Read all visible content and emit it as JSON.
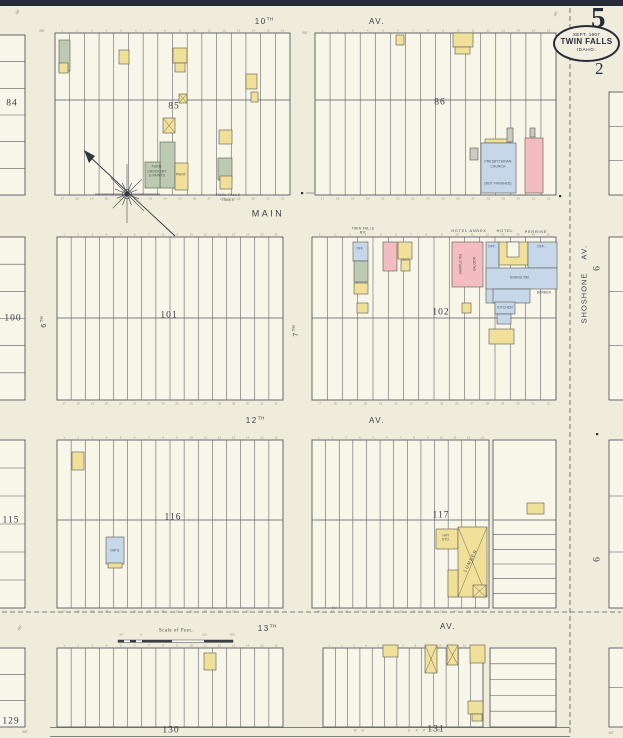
{
  "sheet": {
    "number": "5",
    "sub_number": "2",
    "stamp_date": "SEPT. 1907",
    "stamp_city": "TWIN FALLS",
    "stamp_state": "IDAHO."
  },
  "colors": {
    "paper": "#f0ecdc",
    "block_fill": "#f8f5e9",
    "ink": "#565a61",
    "navy": "#262b38",
    "yellow": "#f1e099",
    "pink": "#f3bcc1",
    "blue": "#c7d7ea",
    "green": "#bccab2",
    "gray": "#cbcbc3",
    "white": "#f8f5e9"
  },
  "map": {
    "blocks": [
      {
        "id": "85",
        "x": 55,
        "y": 33,
        "w": 235,
        "h": 162,
        "split": 100,
        "lots": 16,
        "nums": "both"
      },
      {
        "id": "86",
        "x": 315,
        "y": 33,
        "w": 241,
        "h": 162,
        "split": 100,
        "lots": 16,
        "nums": "both"
      },
      {
        "id": "101",
        "x": 57,
        "y": 237,
        "w": 226,
        "h": 163,
        "split": 318,
        "lots": 16,
        "nums": "both"
      },
      {
        "id": "102",
        "x": 312,
        "y": 237,
        "w": 244,
        "h": 163,
        "split": 318,
        "lots": 16,
        "nums": "both"
      },
      {
        "id": "116",
        "x": 57,
        "y": 440,
        "w": 226,
        "h": 168,
        "split": 520,
        "lots": 16,
        "nums": "both"
      },
      {
        "id": "117",
        "x": 312,
        "y": 440,
        "w": 177,
        "h": 168,
        "split": 520,
        "lots": 13,
        "nums": "both"
      },
      {
        "id": "117-side",
        "x": 493,
        "y": 440,
        "w": 63,
        "h": 168,
        "split": 520,
        "hb": 6
      },
      {
        "id": "130",
        "x": 57,
        "y": 648,
        "w": 226,
        "h": 79,
        "lots": 16,
        "nums": "top"
      },
      {
        "id": "131",
        "x": 323,
        "y": 648,
        "w": 160,
        "h": 79,
        "lots": 13,
        "nums": "top"
      },
      {
        "id": "131-side",
        "x": 490,
        "y": 648,
        "w": 66,
        "h": 79,
        "hrows": 5
      },
      {
        "id": "84",
        "x": -3,
        "y": 35,
        "w": 28,
        "h": 160,
        "hrows": 6
      },
      {
        "id": "100",
        "x": -3,
        "y": 237,
        "w": 28,
        "h": 163,
        "hrows": 6
      },
      {
        "id": "115",
        "x": -3,
        "y": 440,
        "w": 28,
        "h": 168,
        "hrows": 6
      },
      {
        "id": "129",
        "x": -3,
        "y": 648,
        "w": 28,
        "h": 79,
        "hrows": 3
      },
      {
        "id": "right-1",
        "x": 609,
        "y": 92,
        "w": 15,
        "h": 103,
        "hrows": 3
      },
      {
        "id": "right-2",
        "x": 609,
        "y": 237,
        "w": 15,
        "h": 163,
        "hrows": 3
      },
      {
        "id": "right-3",
        "x": 609,
        "y": 440,
        "w": 15,
        "h": 168,
        "hrows": 3
      },
      {
        "id": "right-4",
        "x": 609,
        "y": 648,
        "w": 15,
        "h": 79,
        "hrows": 2
      }
    ],
    "lines": [
      [
        50,
        727.5,
        570,
        727.5,
        0.7,
        ""
      ],
      [
        50,
        736.5,
        570,
        736.5,
        0.7,
        ""
      ],
      [
        570,
        8,
        570,
        736,
        0.8,
        "5 3"
      ],
      [
        2,
        612,
        621,
        612,
        0.8,
        "5 3"
      ],
      [
        306,
        193,
        314,
        193,
        0.6,
        ""
      ]
    ],
    "buildings": [
      {
        "x": 59,
        "y": 40,
        "w": 11,
        "h": 31,
        "c": "green"
      },
      {
        "x": 59,
        "y": 63,
        "w": 9,
        "h": 10,
        "c": "yellow"
      },
      {
        "x": 119,
        "y": 50,
        "w": 10,
        "h": 14,
        "c": "yellow"
      },
      {
        "x": 173,
        "y": 48,
        "w": 14,
        "h": 15,
        "c": "yellow"
      },
      {
        "x": 175,
        "y": 63,
        "w": 10,
        "h": 9,
        "c": "yellow"
      },
      {
        "x": 179,
        "y": 94,
        "w": 8,
        "h": 9,
        "c": "yellow",
        "m": true
      },
      {
        "x": 246,
        "y": 74,
        "w": 11,
        "h": 15,
        "c": "yellow"
      },
      {
        "x": 251,
        "y": 92,
        "w": 7,
        "h": 10,
        "c": "yellow"
      },
      {
        "x": 163,
        "y": 118,
        "w": 12,
        "h": 15,
        "c": "yellow",
        "m": true
      },
      {
        "x": 160,
        "y": 142,
        "w": 15,
        "h": 46,
        "c": "green"
      },
      {
        "x": 145,
        "y": 162,
        "w": 15,
        "h": 26,
        "c": "green"
      },
      {
        "x": 175,
        "y": 163,
        "w": 13,
        "h": 27,
        "c": "yellow"
      },
      {
        "x": 219,
        "y": 130,
        "w": 13,
        "h": 14,
        "c": "yellow"
      },
      {
        "x": 218,
        "y": 158,
        "w": 14,
        "h": 22,
        "c": "green"
      },
      {
        "x": 220,
        "y": 176,
        "w": 12,
        "h": 13,
        "c": "yellow"
      },
      {
        "x": 396,
        "y": 35,
        "w": 8,
        "h": 10,
        "c": "yellow"
      },
      {
        "x": 453,
        "y": 33,
        "w": 20,
        "h": 14,
        "c": "yellow"
      },
      {
        "x": 455,
        "y": 47,
        "w": 15,
        "h": 7,
        "c": "yellow"
      },
      {
        "x": 485,
        "y": 139,
        "w": 25,
        "h": 4,
        "c": "yellow"
      },
      {
        "x": 481,
        "y": 143,
        "w": 35,
        "h": 50,
        "c": "blue"
      },
      {
        "x": 470,
        "y": 148,
        "w": 8,
        "h": 12,
        "c": "gray"
      },
      {
        "x": 507,
        "y": 128,
        "w": 6,
        "h": 14,
        "c": "gray"
      },
      {
        "x": 525,
        "y": 138,
        "w": 18,
        "h": 55,
        "c": "pink"
      },
      {
        "x": 530,
        "y": 128,
        "w": 5,
        "h": 9,
        "c": "gray"
      },
      {
        "x": 353,
        "y": 242,
        "w": 15,
        "h": 19,
        "c": "blue"
      },
      {
        "x": 354,
        "y": 261,
        "w": 14,
        "h": 21,
        "c": "green"
      },
      {
        "x": 354,
        "y": 283,
        "w": 14,
        "h": 11,
        "c": "yellow"
      },
      {
        "x": 357,
        "y": 303,
        "w": 11,
        "h": 10,
        "c": "yellow"
      },
      {
        "x": 383,
        "y": 242,
        "w": 14,
        "h": 29,
        "c": "pink"
      },
      {
        "x": 398,
        "y": 242,
        "w": 14,
        "h": 17,
        "c": "yellow"
      },
      {
        "x": 401,
        "y": 260,
        "w": 9,
        "h": 11,
        "c": "yellow"
      },
      {
        "x": 452,
        "y": 242,
        "w": 31,
        "h": 45,
        "c": "pink"
      },
      {
        "x": 486,
        "y": 242,
        "w": 13,
        "h": 61,
        "c": "blue"
      },
      {
        "x": 499,
        "y": 242,
        "w": 29,
        "h": 23,
        "c": "yellow"
      },
      {
        "x": 507,
        "y": 242,
        "w": 12,
        "h": 15,
        "c": "white"
      },
      {
        "x": 528,
        "y": 242,
        "w": 29,
        "h": 26,
        "c": "blue"
      },
      {
        "x": 486,
        "y": 268,
        "w": 71,
        "h": 21,
        "c": "blue"
      },
      {
        "x": 493,
        "y": 289,
        "w": 37,
        "h": 14,
        "c": "blue"
      },
      {
        "x": 495,
        "y": 302,
        "w": 20,
        "h": 12,
        "c": "blue"
      },
      {
        "x": 497,
        "y": 314,
        "w": 14,
        "h": 10,
        "c": "blue"
      },
      {
        "x": 462,
        "y": 303,
        "w": 9,
        "h": 10,
        "c": "yellow"
      },
      {
        "x": 489,
        "y": 329,
        "w": 25,
        "h": 15,
        "c": "yellow"
      },
      {
        "x": 72,
        "y": 452,
        "w": 12,
        "h": 18,
        "c": "yellow"
      },
      {
        "x": 106,
        "y": 537,
        "w": 18,
        "h": 27,
        "c": "blue"
      },
      {
        "x": 108,
        "y": 563,
        "w": 14,
        "h": 5,
        "c": "yellow"
      },
      {
        "x": 527,
        "y": 503,
        "w": 17,
        "h": 11,
        "c": "yellow"
      },
      {
        "x": 436,
        "y": 529,
        "w": 22,
        "h": 20,
        "c": "yellow"
      },
      {
        "x": 458,
        "y": 527,
        "w": 29,
        "h": 70,
        "c": "yellow",
        "m": true
      },
      {
        "x": 448,
        "y": 570,
        "w": 10,
        "h": 27,
        "c": "yellow"
      },
      {
        "x": 473,
        "y": 585,
        "w": 13,
        "h": 12,
        "c": "yellow",
        "m": true
      },
      {
        "x": 204,
        "y": 653,
        "w": 12,
        "h": 17,
        "c": "yellow"
      },
      {
        "x": 383,
        "y": 645,
        "w": 15,
        "h": 12,
        "c": "yellow"
      },
      {
        "x": 425,
        "y": 645,
        "w": 12,
        "h": 28,
        "c": "yellow",
        "m": true
      },
      {
        "x": 447,
        "y": 645,
        "w": 11,
        "h": 20,
        "c": "yellow",
        "m": true
      },
      {
        "x": 470,
        "y": 645,
        "w": 15,
        "h": 18,
        "c": "yellow"
      },
      {
        "x": 468,
        "y": 701,
        "w": 15,
        "h": 13,
        "c": "yellow"
      },
      {
        "x": 472,
        "y": 714,
        "w": 10,
        "h": 7,
        "c": "yellow"
      }
    ],
    "dots": [
      [
        301,
        192
      ],
      [
        559,
        195
      ],
      [
        596,
        433
      ]
    ],
    "compass": {
      "cx": 127,
      "cy": 194,
      "x1": 88,
      "y1": 155,
      "x2": 175,
      "y2": 236
    },
    "scale": {
      "x": 118,
      "w": 115
    },
    "labels": [
      {
        "k": "st",
        "t": "10",
        "sup": "TH",
        "x": 264,
        "y": 22
      },
      {
        "k": "st",
        "t": "AV.",
        "x": 377,
        "y": 22
      },
      {
        "k": "st",
        "t": "MAIN",
        "x": 268,
        "y": 214,
        "s": 9,
        "ls": 2.5
      },
      {
        "k": "st",
        "t": "12",
        "sup": "TH",
        "x": 255,
        "y": 421
      },
      {
        "k": "st",
        "t": "AV.",
        "x": 377,
        "y": 421
      },
      {
        "k": "st",
        "t": "13",
        "sup": "TH",
        "x": 267,
        "y": 629
      },
      {
        "k": "st",
        "t": "AV.",
        "x": 448,
        "y": 627
      },
      {
        "k": "st",
        "t": "SHOSHONE",
        "x": 584,
        "y": 298,
        "r": -90,
        "s": 7.5,
        "ls": 1
      },
      {
        "k": "st",
        "t": "AV.",
        "x": 584,
        "y": 252,
        "r": -90,
        "s": 7.5
      },
      {
        "k": "st",
        "t": "6",
        "sup": "TH",
        "x": 44,
        "y": 322,
        "r": -90,
        "s": 7
      },
      {
        "k": "st",
        "t": "7",
        "sup": "TH",
        "x": 296,
        "y": 331,
        "r": -90,
        "s": 7
      },
      {
        "k": "bn",
        "t": "85",
        "x": 174,
        "y": 107
      },
      {
        "k": "bn",
        "t": "86",
        "x": 440,
        "y": 103
      },
      {
        "k": "bn",
        "t": "101",
        "x": 169,
        "y": 316
      },
      {
        "k": "bn",
        "t": "102",
        "x": 441,
        "y": 313
      },
      {
        "k": "bn",
        "t": "116",
        "x": 173,
        "y": 518
      },
      {
        "k": "bn",
        "t": "117",
        "x": 441,
        "y": 516
      },
      {
        "k": "bn",
        "t": "130",
        "x": 171,
        "y": 731
      },
      {
        "k": "bn",
        "t": "131",
        "x": 436,
        "y": 730
      },
      {
        "k": "bn",
        "t": "84",
        "x": 12,
        "y": 104
      },
      {
        "k": "bn",
        "t": "100",
        "x": 13,
        "y": 319
      },
      {
        "k": "bn",
        "t": "115",
        "x": 11,
        "y": 521
      },
      {
        "k": "bn",
        "t": "129",
        "x": 11,
        "y": 722
      },
      {
        "k": "bn",
        "t": "6",
        "x": 598,
        "y": 268,
        "r": -90
      },
      {
        "k": "bn",
        "t": "6",
        "x": 598,
        "y": 559,
        "r": -90
      },
      {
        "k": "cap",
        "t": "TWIN FALLS",
        "x": 228,
        "y": 196,
        "s": 3.6
      },
      {
        "k": "cap",
        "t": "“TIMES”",
        "x": 228,
        "y": 201,
        "s": 3.6
      },
      {
        "k": "cap",
        "t": "TWIN FALLS",
        "x": 363,
        "y": 229,
        "s": 3.2
      },
      {
        "k": "cap",
        "t": "B'K",
        "x": 363,
        "y": 233,
        "s": 3.2
      },
      {
        "k": "cap",
        "t": "HOTEL ANNEX",
        "x": 469,
        "y": 232,
        "s": 3.8,
        "ls": 0.8
      },
      {
        "k": "cap",
        "t": "HOTEL",
        "x": 505,
        "y": 232,
        "s": 3.8,
        "ls": 0.8
      },
      {
        "k": "cap",
        "t": "PERRINE",
        "x": 536,
        "y": 233,
        "s": 3.8,
        "ls": 0.8
      },
      {
        "k": "scale",
        "t": "Scale of Feet.",
        "x": 176,
        "y": 631
      },
      {
        "k": "bld",
        "t": "FURN.",
        "x": 157,
        "y": 167
      },
      {
        "k": "bld",
        "t": "CROCKERY",
        "x": 157,
        "y": 171.5
      },
      {
        "k": "bld",
        "t": "& PAINTS",
        "x": 157,
        "y": 176
      },
      {
        "k": "bld",
        "t": "PAINT",
        "x": 181,
        "y": 175
      },
      {
        "k": "bld",
        "t": "PRESBYTERIAN",
        "x": 498,
        "y": 162
      },
      {
        "k": "bld",
        "t": "CHURCH",
        "x": 498,
        "y": 166.5
      },
      {
        "k": "bld",
        "t": "(NOT FINISHED)",
        "x": 498,
        "y": 184
      },
      {
        "k": "bld",
        "t": "SAMPLE RM",
        "x": 461,
        "y": 264,
        "r": -90
      },
      {
        "k": "bld",
        "t": "SALOON",
        "x": 475,
        "y": 264,
        "r": -90
      },
      {
        "k": "bld",
        "t": "OFF.",
        "x": 360,
        "y": 249
      },
      {
        "k": "bld",
        "t": "OFF.",
        "x": 492,
        "y": 247
      },
      {
        "k": "bld",
        "t": "OFF.",
        "x": 541,
        "y": 247
      },
      {
        "k": "bld",
        "t": "DINING RM.",
        "x": 520,
        "y": 278
      },
      {
        "k": "bld",
        "t": "KITCHEN",
        "x": 505,
        "y": 308
      },
      {
        "k": "bld",
        "t": "BARBER",
        "x": 544,
        "y": 293
      },
      {
        "k": "bld",
        "t": "HAY",
        "x": 446,
        "y": 536
      },
      {
        "k": "bld",
        "t": "STO.",
        "x": 446,
        "y": 540
      },
      {
        "k": "bld",
        "t": "LUMBER",
        "x": 471,
        "y": 561,
        "s": 4.5,
        "r": -62,
        "ls": 1
      },
      {
        "k": "bld",
        "t": "DW'G",
        "x": 115,
        "y": 551
      },
      {
        "k": "dim",
        "t": "50'",
        "x": 18,
        "y": 12,
        "r": -65
      },
      {
        "k": "dim",
        "t": "60'",
        "x": 42,
        "y": 31
      },
      {
        "k": "dim",
        "t": "60'",
        "x": 305,
        "y": 33
      },
      {
        "k": "dim",
        "t": "66'",
        "x": 334,
        "y": 608
      },
      {
        "k": "dim",
        "t": "60'",
        "x": 20,
        "y": 628,
        "r": -65
      },
      {
        "k": "dim",
        "t": "60'",
        "x": 25,
        "y": 732
      },
      {
        "k": "dim",
        "t": "52'",
        "x": 611,
        "y": 733
      },
      {
        "k": "dim",
        "t": "40'",
        "x": 556,
        "y": 14,
        "r": -65
      },
      {
        "k": "dim",
        "t": "N O",
        "x": 360,
        "y": 731,
        "s": 3.5,
        "ls": 2
      },
      {
        "k": "dim",
        "t": "E X P O S .",
        "x": 428,
        "y": 731,
        "s": 3.5,
        "ls": 2
      },
      {
        "k": "tick",
        "t": "50",
        "x": 121,
        "y": 635
      },
      {
        "k": "tick",
        "t": "0",
        "x": 141,
        "y": 635
      },
      {
        "k": "tick",
        "t": "100",
        "x": 204,
        "y": 635
      },
      {
        "k": "tick",
        "t": "150",
        "x": 232,
        "y": 635
      }
    ]
  }
}
